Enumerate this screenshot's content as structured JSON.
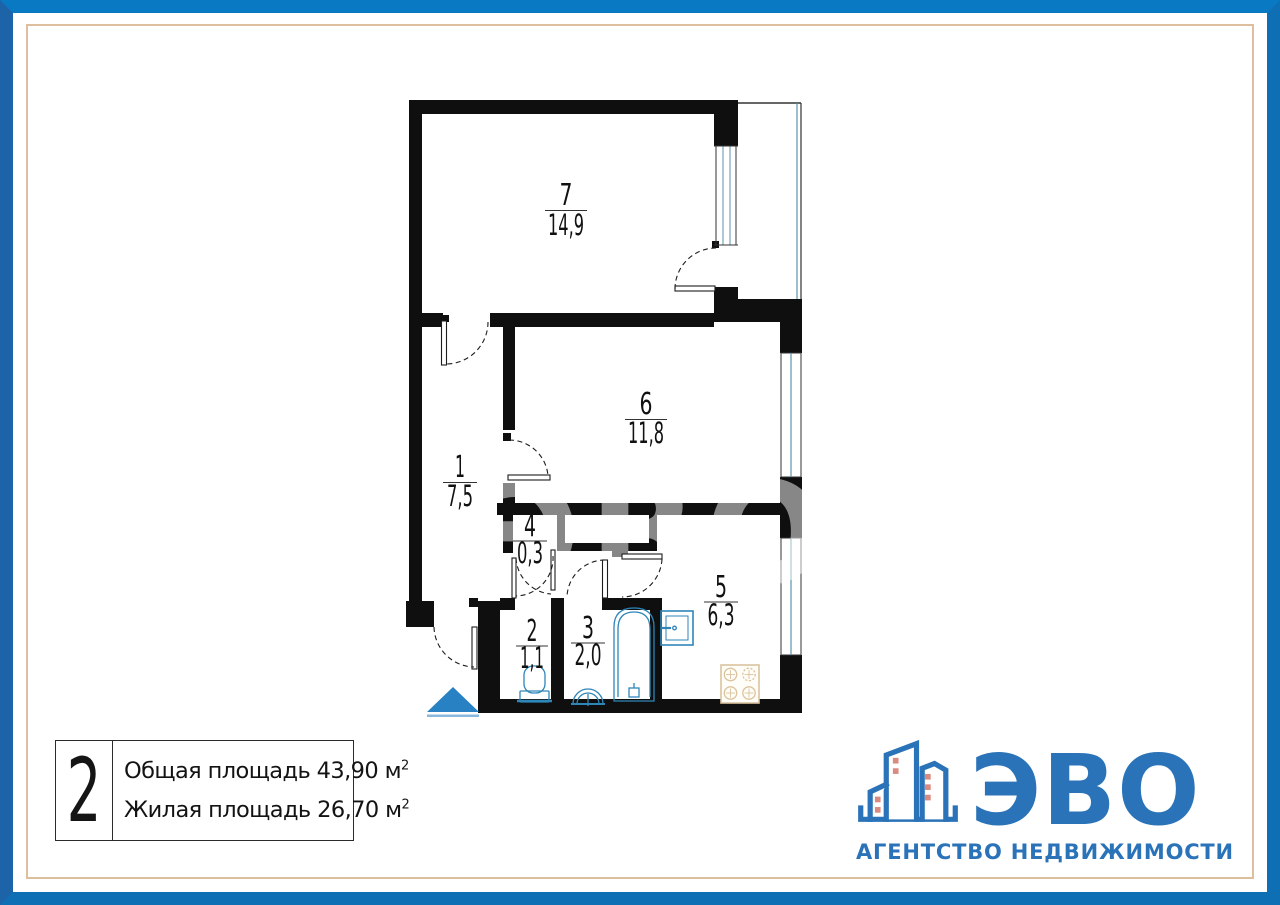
{
  "plan": {
    "watermark": "ЭВО",
    "rooms": [
      {
        "number": "7",
        "area": "14,9"
      },
      {
        "number": "6",
        "area": "11,8"
      },
      {
        "number": "1",
        "area": "7,5"
      },
      {
        "number": "4",
        "area": "0,3"
      },
      {
        "number": "2",
        "area": "1,1"
      },
      {
        "number": "3",
        "area": "2,0"
      },
      {
        "number": "5",
        "area": "6,3"
      }
    ],
    "colors": {
      "wall": "#0f0f0f",
      "fixture_blue": "#2e86b8",
      "window_blue": "#5d93ad",
      "stove_beige": "#dbc39e",
      "entrance_triangle": "#2781c2"
    }
  },
  "info_box": {
    "number": "2",
    "total_label": "Общая площадь",
    "total_value": "43,90 м",
    "living_label": "Жилая площадь",
    "living_value": "26,70 м",
    "sup": "2"
  },
  "logo": {
    "title": "ЭВО",
    "subtitle": "АГЕНТСТВО НЕДВИЖИМОСТИ",
    "blue": "#2b73b8",
    "window_red": "#d98b80"
  },
  "frame": {
    "border_blue_top": "#0a79c3",
    "border_blue_left": "#1c63a8",
    "border_blue_right_bottom": "#0f6fb4",
    "inner_tan": "#ddbe9e"
  }
}
